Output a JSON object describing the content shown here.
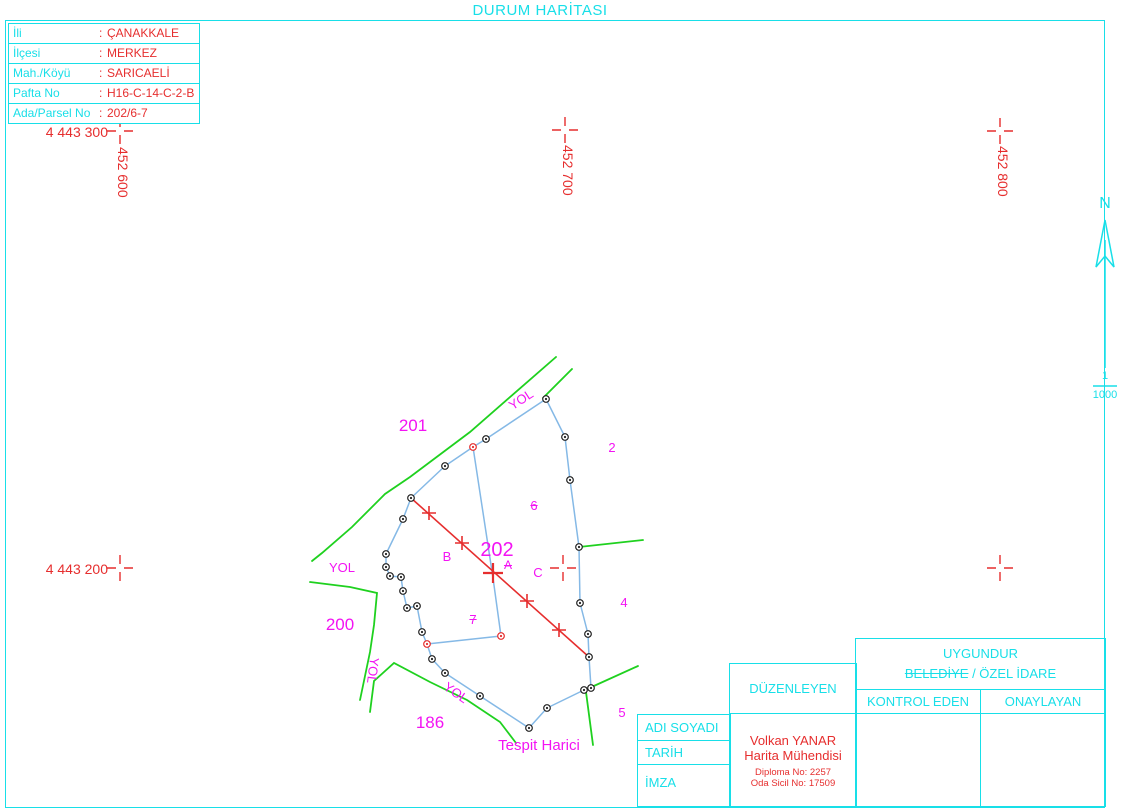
{
  "title": "DURUM HARİTASI",
  "info_table": {
    "colon": ":",
    "rows": [
      {
        "label": "İli",
        "value": "ÇANAKKALE"
      },
      {
        "label": "İlçesi",
        "value": "MERKEZ"
      },
      {
        "label": "Mah./Köyü",
        "value": "SARICAELİ"
      },
      {
        "label": "Pafta No",
        "value": "H16-C-14-C-2-B"
      },
      {
        "label": "Ada/Parsel No",
        "value": "202/6-7"
      }
    ]
  },
  "grid": {
    "northing_top": "4 443 300",
    "northing_mid": "4 443 200",
    "easting_left": "452 600",
    "easting_mid": "452 700",
    "easting_right": "452 800"
  },
  "north_arrow": {
    "label": "N",
    "scale_numerator": "1",
    "scale_denominator": "1000"
  },
  "map": {
    "parcels": {
      "p201": "201",
      "p202": "202",
      "p200": "200",
      "p186": "186",
      "p2": "2",
      "p4": "4",
      "p5": "5",
      "p6": "6",
      "p7": "7"
    },
    "points": {
      "a": "A",
      "b": "B",
      "c": "C"
    },
    "road_label": "YOL",
    "note": "Tespit Harici"
  },
  "approval": {
    "uygundur": "UYGUNDUR",
    "authority_struck": "BELEDİYE",
    "authority_rest": "/ ÖZEL İDARE",
    "kontrol_eden": "KONTROL EDEN",
    "onaylayan": "ONAYLAYAN",
    "duzenleyen": "DÜZENLEYEN",
    "rows": [
      "ADI SOYADI",
      "TARİH",
      "İMZA"
    ],
    "engineer": {
      "name": "Volkan YANAR",
      "title": "Harita Mühendisi",
      "diploma": "Diploma No: 2257",
      "registry": "Oda Sicil No: 17509"
    }
  },
  "colors": {
    "cyan": "#18dfe8",
    "red": "#e62e2e",
    "magenta": "#f313f3",
    "green": "#1fd11f",
    "parcel_blue": "#85b9e6"
  }
}
